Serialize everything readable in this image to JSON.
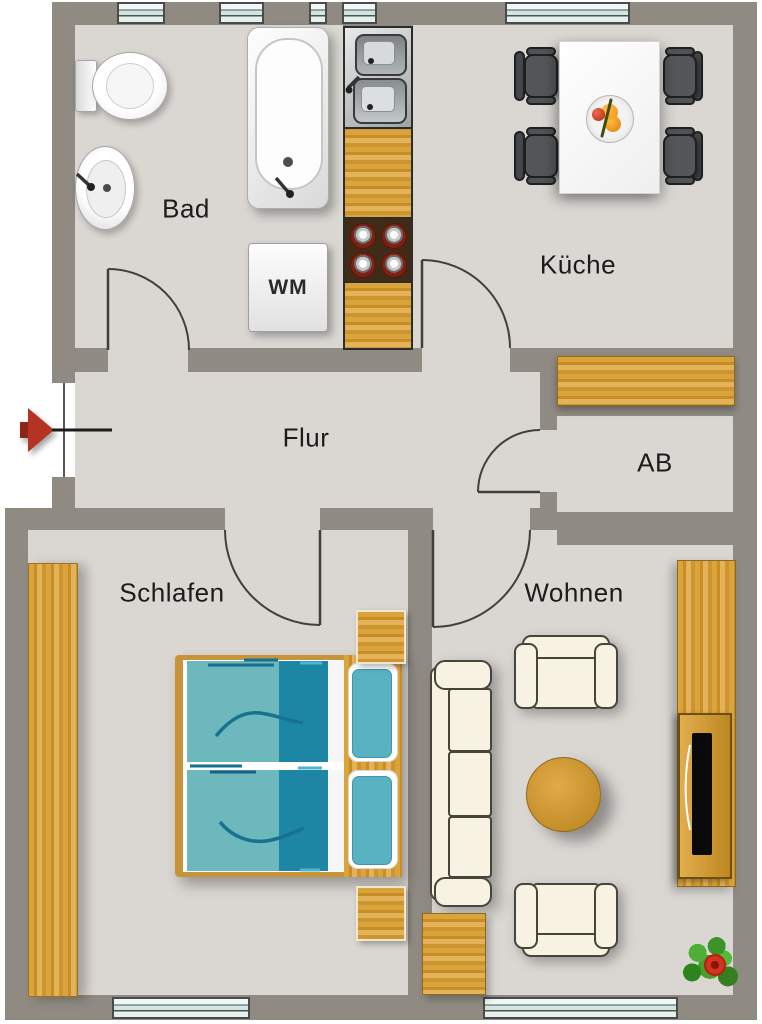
{
  "plan": {
    "title": "Wohnungsgrundriss",
    "rooms": [
      {
        "id": "bad",
        "label": "Bad"
      },
      {
        "id": "kueche",
        "label": "Küche"
      },
      {
        "id": "flur",
        "label": "Flur"
      },
      {
        "id": "ab",
        "label": "AB"
      },
      {
        "id": "schlafen",
        "label": "Schlafen"
      },
      {
        "id": "wohnen",
        "label": "Wohnen"
      }
    ],
    "appliance_labels": {
      "washing_machine": "WM"
    },
    "colors": {
      "wall": "#8f8a82",
      "floor": "#dad7d3",
      "outside": "#ffffff",
      "wood": "#cd9530",
      "window_glass": "#cfe7e3",
      "duvet_light": "#6cb8bd",
      "duvet_dark": "#1d86a4",
      "pillow_teal": "#58b2c1",
      "chair_gray": "#54575a",
      "sofa_cream": "#f7f2e1",
      "entrance_arrow_red": "#b53322",
      "stove_brown": "#402c16",
      "plant_green": "#3c9a28",
      "flower_red": "#d5321f"
    }
  }
}
